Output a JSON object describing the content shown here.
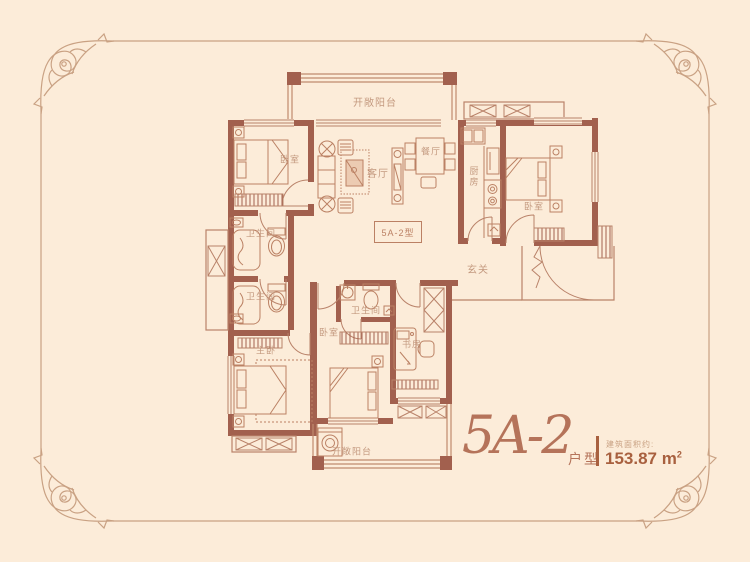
{
  "plan": {
    "unit_box_label": "5A-2型",
    "rooms": {
      "balcony_top": "开敞阳台",
      "bedroom_top_left": "卧室",
      "living_room": "客厅",
      "dining_room": "餐厅",
      "kitchen": "厨房",
      "bedroom_top_right": "卧室",
      "bath_upper": "卫生间",
      "bath_lower": "卫生间",
      "entry": "玄关",
      "master_bedroom": "主卧",
      "bedroom_mid": "卧室",
      "bath_mid": "卫生间",
      "study": "书房",
      "balcony_bottom": "开敞阳台"
    }
  },
  "title": {
    "unit_name": "5A-2",
    "unit_suffix": "户型",
    "area_label": "建筑面积约:",
    "area_value": "153.87 m",
    "area_superscript": "2"
  },
  "colors": {
    "background": "#fcecd9",
    "wall": "#a2604e",
    "line": "#b98269",
    "label_text": "#c49a80",
    "accent": "#a8603f",
    "frame": "#c9a183"
  }
}
